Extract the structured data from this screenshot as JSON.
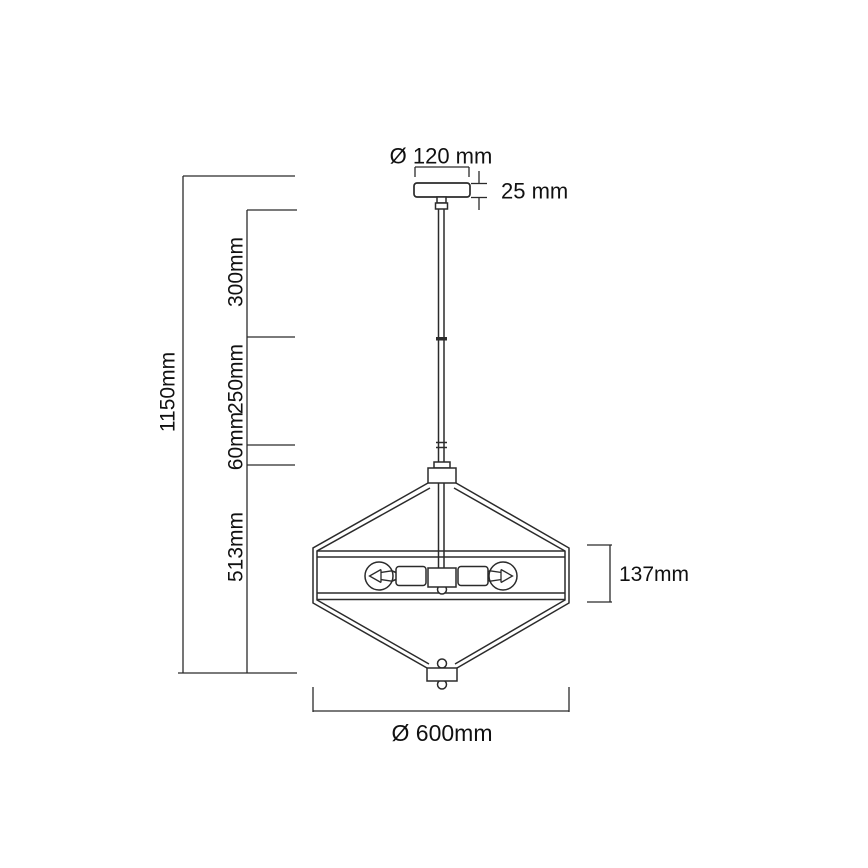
{
  "page": {
    "background": "#ffffff",
    "kind": "pendant-lamp-dimension-diagram"
  },
  "colors": {
    "line": "#2b2b2b",
    "text": "#111111"
  },
  "drawing": {
    "canopy": {
      "diameter": "Ø 120 mm",
      "thickness": "25 mm"
    },
    "suspension": {
      "total_height": "1150mm",
      "segments": [
        "300mm",
        "250mm",
        "60mm",
        "513mm"
      ]
    },
    "shade": {
      "band_height": "137mm",
      "diameter": "Ø 600mm"
    }
  }
}
